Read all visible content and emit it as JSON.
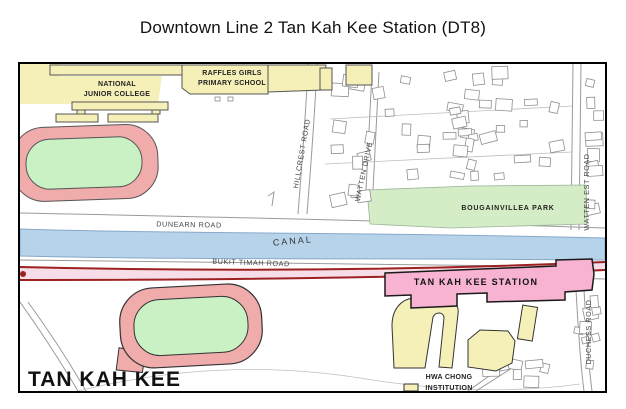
{
  "title": "Downtown Line 2 Tan Kah Kee Station (DT8)",
  "map": {
    "labels": {
      "national_junior_college_1": "NATIONAL",
      "national_junior_college_2": "JUNIOR COLLEGE",
      "raffles_girls_1": "RAFFLES GIRLS",
      "raffles_girls_2": "PRIMARY SCHOOL",
      "hillcrest_road": "HILLCREST ROAD",
      "watten_drive": "WATTEN DRIVE",
      "watten_est_road": "WATTEN EST ROAD",
      "bougainvillea_park": "BOUGAINVILLEA PARK",
      "dunearn_road": "DUNEARN ROAD",
      "canal": "CANAL",
      "bukit_timah_road": "BUKIT TIMAH ROAD",
      "tan_kah_kee_station": "TAN KAH KEE STATION",
      "tan_kah_kee_area": "TAN KAH KEE",
      "hwa_chong_1": "HWA CHONG",
      "hwa_chong_2": "INSTITUTION",
      "duchess_road": "DUCHESS ROAD"
    },
    "colors": {
      "school_fill": "#f5f0b8",
      "track_ring": "#f0abab",
      "field_green": "#c9f1c4",
      "park_green": "#d5edc6",
      "canal_blue": "#b6d3ea",
      "station_pink": "#f7b3d1",
      "rail_red": "#9e2121",
      "rail_fill": "#f6dde7"
    }
  }
}
